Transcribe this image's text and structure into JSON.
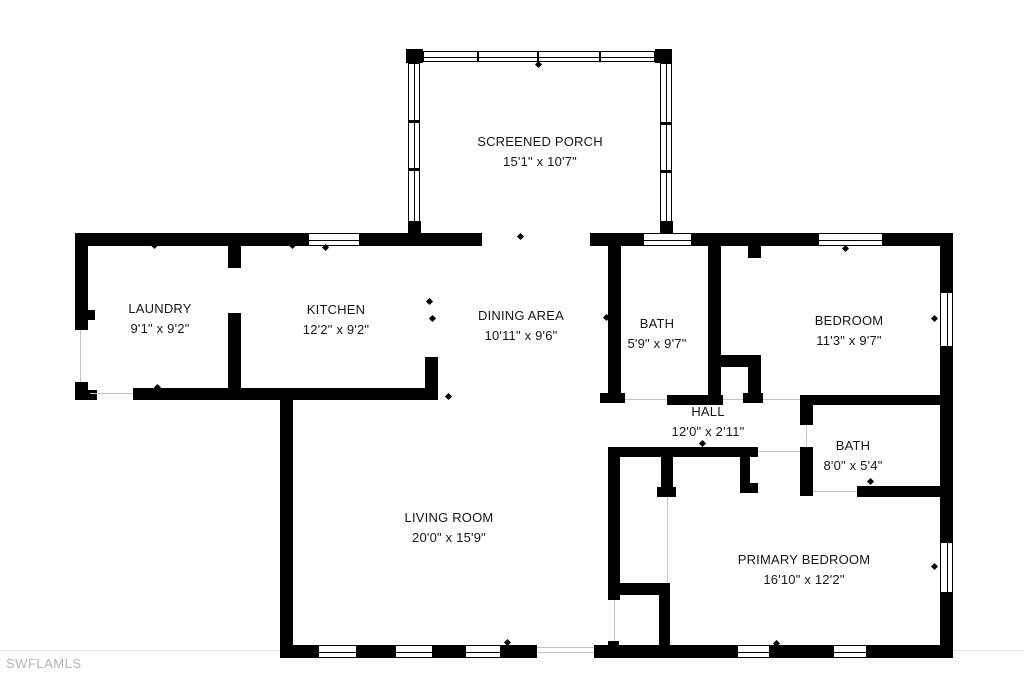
{
  "watermark": "SWFLAMLS",
  "colors": {
    "wall": "#000000",
    "background": "#ffffff",
    "watermark": "#b3b3b3"
  },
  "rooms": [
    {
      "name": "SCREENED PORCH",
      "dims": "15'1\" x 10'7\""
    },
    {
      "name": "LAUNDRY",
      "dims": "9'1\" x 9'2\""
    },
    {
      "name": "KITCHEN",
      "dims": "12'2\" x 9'2\""
    },
    {
      "name": "DINING AREA",
      "dims": "10'11\" x 9'6\""
    },
    {
      "name": "BATH",
      "dims": "5'9\" x 9'7\""
    },
    {
      "name": "BEDROOM",
      "dims": "11'3\" x 9'7\""
    },
    {
      "name": "HALL",
      "dims": "12'0\" x 2'11\""
    },
    {
      "name": "BATH",
      "dims": "8'0\" x 5'4\""
    },
    {
      "name": "LIVING ROOM",
      "dims": "20'0\" x 15'9\""
    },
    {
      "name": "PRIMARY BEDROOM",
      "dims": "16'10\" x 12'2\""
    }
  ]
}
